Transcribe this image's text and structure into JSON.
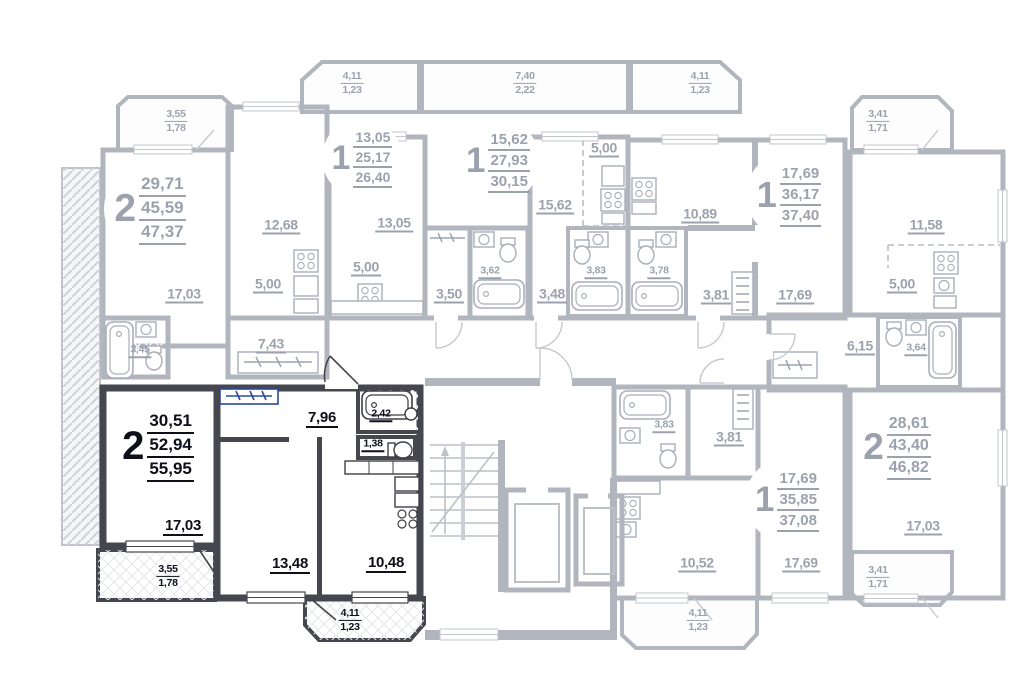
{
  "plan": {
    "type": "residential-floor-plan",
    "highlighted_unit": {
      "rooms": "2",
      "living_area": "30,51",
      "area": "52,94",
      "total_area": "55,95"
    }
  },
  "colors": {
    "highlight_fill": "#b5cdf0",
    "highlight_wall": "#46464e",
    "highlight_text": "#0f0f1a",
    "muted_wall": "#b1b5be",
    "muted_text": "#9ba2ad",
    "green_fill": "#e4ecc9",
    "yellow_fill": "#f3f6c3",
    "blue_fill": "#dce6f4",
    "bath_fill": "#cbe3f7",
    "bath_fill_highlight": "#a2c9f0"
  },
  "badges": [
    {
      "name": "apartment-top-left",
      "number": "2",
      "areas": [
        "29,71",
        "45,59",
        "47,37"
      ],
      "x": 150,
      "y": 209,
      "d": 92,
      "variant": "muted"
    },
    {
      "name": "apartment-top-b",
      "number": "1",
      "areas": [
        "13,05",
        "25,17",
        "26,40"
      ],
      "x": 362,
      "y": 158,
      "d": 80,
      "variant": "muted"
    },
    {
      "name": "apartment-top-c",
      "number": "1",
      "areas": [
        "15,62",
        "27,93",
        "30,15"
      ],
      "x": 498,
      "y": 161,
      "d": 84,
      "variant": "muted"
    },
    {
      "name": "apartment-top-d",
      "number": "1",
      "areas": [
        "17,69",
        "36,17",
        "37,40"
      ],
      "x": 789,
      "y": 195,
      "d": 86,
      "variant": "muted"
    },
    {
      "name": "apartment-right",
      "number": "2",
      "areas": [
        "28,61",
        "43,40",
        "46,82"
      ],
      "x": 897,
      "y": 447,
      "d": 88,
      "variant": "muted"
    },
    {
      "name": "apartment-bottom-middle",
      "number": "1",
      "areas": [
        "17,69",
        "35,85",
        "37,08"
      ],
      "x": 787,
      "y": 500,
      "d": 84,
      "variant": "muted"
    },
    {
      "name": "apartment-highlighted",
      "number": "2",
      "areas": [
        "30,51",
        "52,94",
        "55,95"
      ],
      "x": 158,
      "y": 446,
      "d": 96,
      "variant": "dark"
    }
  ],
  "room_labels": [
    {
      "text": "17,03",
      "x": 184,
      "y": 295,
      "variant": "muted",
      "size": "md"
    },
    {
      "text": "12,68",
      "x": 281,
      "y": 226,
      "variant": "muted",
      "size": "md"
    },
    {
      "text": "5,00",
      "x": 268,
      "y": 285,
      "variant": "muted",
      "size": "md"
    },
    {
      "text": "7,43",
      "x": 271,
      "y": 345,
      "variant": "muted",
      "size": "md"
    },
    {
      "text": "3,45",
      "x": 140,
      "y": 351,
      "variant": "muted",
      "size": "sm"
    },
    {
      "text": "13,05",
      "x": 394,
      "y": 224,
      "variant": "muted",
      "size": "md"
    },
    {
      "text": "5,00",
      "x": 366,
      "y": 268,
      "variant": "muted",
      "size": "md"
    },
    {
      "text": "3,50",
      "x": 449,
      "y": 295,
      "variant": "muted",
      "size": "md"
    },
    {
      "text": "3,62",
      "x": 490,
      "y": 272,
      "variant": "muted",
      "size": "sm"
    },
    {
      "text": "15,62",
      "x": 555,
      "y": 206,
      "variant": "muted",
      "size": "md"
    },
    {
      "text": "5,00",
      "x": 604,
      "y": 149,
      "variant": "muted",
      "size": "md"
    },
    {
      "text": "3,48",
      "x": 552,
      "y": 295,
      "variant": "muted",
      "size": "md"
    },
    {
      "text": "3,83",
      "x": 596,
      "y": 272,
      "variant": "muted",
      "size": "sm"
    },
    {
      "text": "10,89",
      "x": 700,
      "y": 215,
      "variant": "muted",
      "size": "md"
    },
    {
      "text": "3,78",
      "x": 659,
      "y": 272,
      "variant": "muted",
      "size": "sm"
    },
    {
      "text": "3,81",
      "x": 716,
      "y": 296,
      "variant": "muted",
      "size": "md"
    },
    {
      "text": "17,69",
      "x": 795,
      "y": 296,
      "variant": "muted",
      "size": "md"
    },
    {
      "text": "11,58",
      "x": 926,
      "y": 226,
      "variant": "muted",
      "size": "md"
    },
    {
      "text": "5,00",
      "x": 902,
      "y": 285,
      "variant": "muted",
      "size": "md"
    },
    {
      "text": "6,15",
      "x": 860,
      "y": 347,
      "variant": "muted",
      "size": "md"
    },
    {
      "text": "3,64",
      "x": 916,
      "y": 349,
      "variant": "muted",
      "size": "sm"
    },
    {
      "text": "17,03",
      "x": 923,
      "y": 527,
      "variant": "muted",
      "size": "md"
    },
    {
      "text": "3,83",
      "x": 664,
      "y": 426,
      "variant": "muted",
      "size": "sm"
    },
    {
      "text": "3,81",
      "x": 729,
      "y": 438,
      "variant": "muted",
      "size": "md"
    },
    {
      "text": "10,52",
      "x": 697,
      "y": 564,
      "variant": "muted",
      "size": "md"
    },
    {
      "text": "17,69",
      "x": 801,
      "y": 564,
      "variant": "muted",
      "size": "md"
    },
    {
      "text": "17,03",
      "x": 183,
      "y": 527,
      "variant": "dark",
      "size": "dk-md"
    },
    {
      "text": "13,48",
      "x": 290,
      "y": 565,
      "variant": "dark",
      "size": "dk-md"
    },
    {
      "text": "10,48",
      "x": 386,
      "y": 564,
      "variant": "dark",
      "size": "dk-md"
    },
    {
      "text": "7,96",
      "x": 322,
      "y": 419,
      "variant": "dark",
      "size": "dk-md"
    },
    {
      "text": "2,42",
      "x": 381,
      "y": 415,
      "variant": "dark",
      "size": "sm"
    },
    {
      "text": "1,38",
      "x": 373,
      "y": 445,
      "variant": "dark",
      "size": "sm"
    }
  ],
  "balcony_labels": [
    {
      "top": "3,55",
      "bottom": "1,78",
      "x": 176,
      "y": 121,
      "variant": "muted"
    },
    {
      "top": "4,11",
      "bottom": "1,23",
      "x": 352,
      "y": 83,
      "variant": "muted"
    },
    {
      "top": "7,40",
      "bottom": "2,22",
      "x": 525,
      "y": 83,
      "variant": "muted"
    },
    {
      "top": "4,11",
      "bottom": "1,23",
      "x": 700,
      "y": 83,
      "variant": "muted"
    },
    {
      "top": "3,41",
      "bottom": "1,71",
      "x": 878,
      "y": 121,
      "variant": "muted"
    },
    {
      "top": "3,41",
      "bottom": "1,71",
      "x": 878,
      "y": 577,
      "variant": "muted"
    },
    {
      "top": "3,55",
      "bottom": "1,78",
      "x": 168,
      "y": 576,
      "variant": "dark"
    },
    {
      "top": "4,11",
      "bottom": "1,23",
      "x": 350,
      "y": 620,
      "variant": "dark"
    },
    {
      "top": "4,11",
      "bottom": "1,23",
      "x": 698,
      "y": 620,
      "variant": "muted"
    }
  ]
}
